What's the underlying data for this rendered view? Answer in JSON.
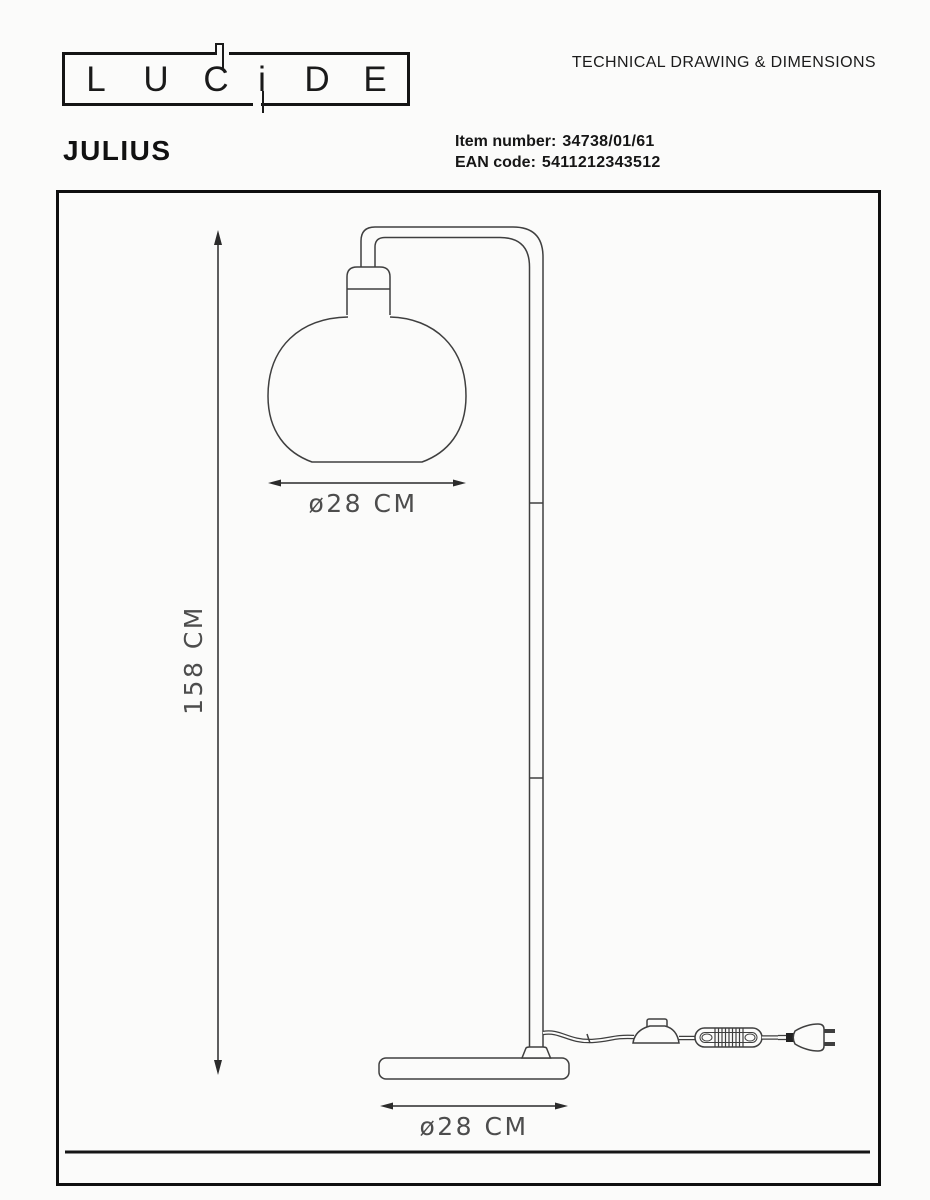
{
  "header": {
    "logo": {
      "letters": [
        "L",
        "U",
        "C",
        "i",
        "D",
        "E"
      ]
    },
    "doc_title": "TECHNICAL DRAWING & DIMENSIONS",
    "product_name": "JULIUS",
    "item_number_label": "Item number:",
    "item_number_value": "34738/01/61",
    "ean_label": "EAN code:",
    "ean_value": "5411212343512"
  },
  "drawing": {
    "total_height_label": "158 CM",
    "shade_diameter_label": "ø28 CM",
    "base_diameter_label": "ø28 CM",
    "colors": {
      "background": "#fbfbfa",
      "line": "#3f3f3f",
      "frame": "#0f0f0f",
      "text": "#161616",
      "dim_text": "#4d4d4d"
    }
  }
}
